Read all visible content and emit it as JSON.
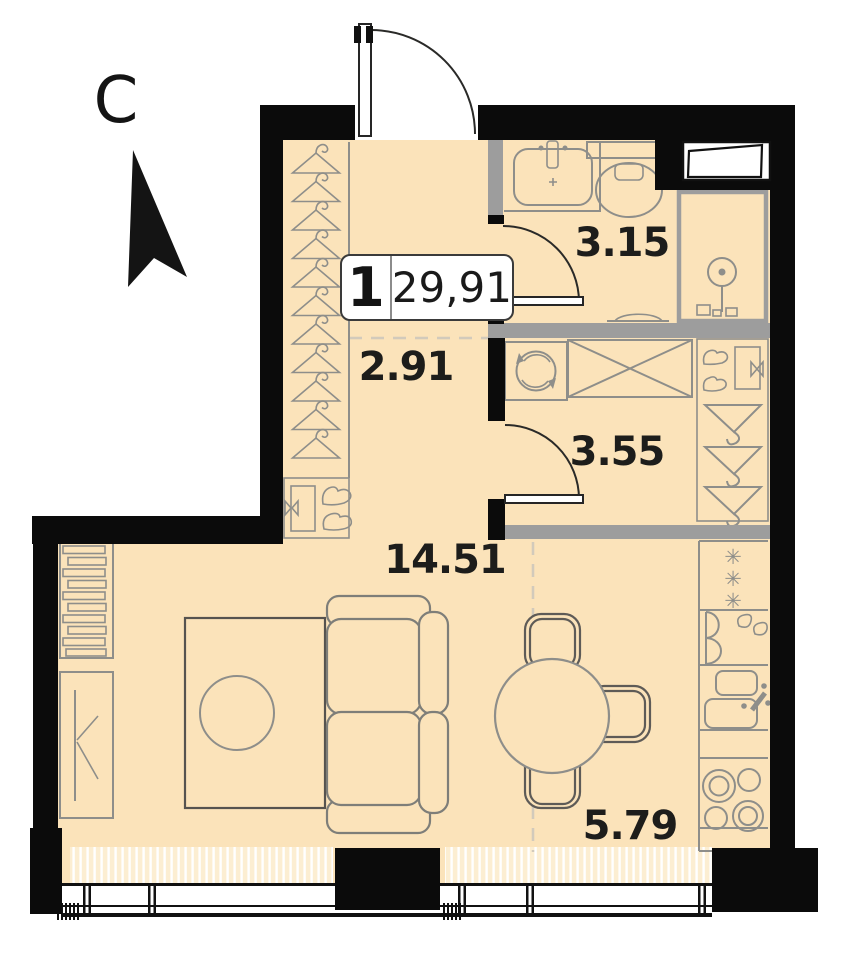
{
  "compass": {
    "letter": "С",
    "direction_name": "north"
  },
  "apartment_label": {
    "rooms_count": "1",
    "total_area": "29,91"
  },
  "room_areas": {
    "bathroom": "3.15",
    "utility_room": "3.55",
    "hallway": "2.91",
    "living_room": "14.51",
    "kitchen": "5.79"
  },
  "icons": {
    "fridge_snowflake": "✳"
  },
  "colors": {
    "floor": "#fbe3ba",
    "wall": "#0b0b0b",
    "partition": "#9d9d9d",
    "furniture_outline": "#8e8e8a",
    "radiator_hatch": "#fceed2"
  }
}
